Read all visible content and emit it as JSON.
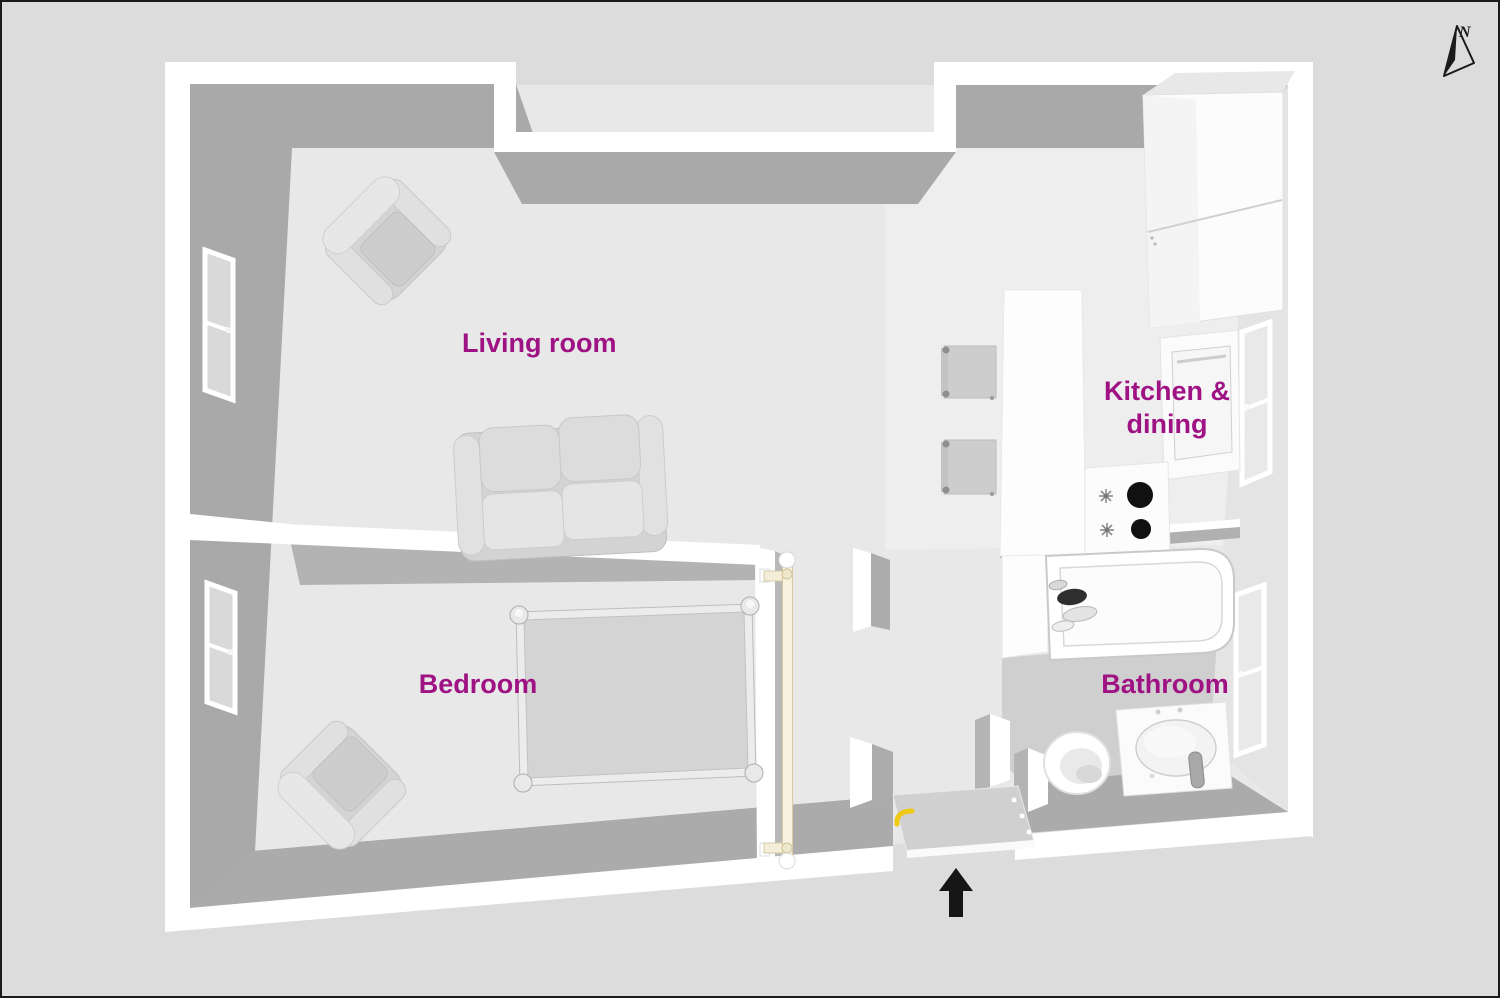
{
  "canvas": {
    "width": 1500,
    "height": 998,
    "background": "#dcdcdc",
    "border": "#1a1a1a"
  },
  "palette": {
    "wall_top": "#ffffff",
    "wall_shadow_face": "#a9a9a9",
    "wall_light_face": "#e4e4e4",
    "floor": "#e8e8e8",
    "floor_kitchen": "#eeeeee",
    "floor_bathroom": "#cfcfcf",
    "furniture_gray": "#d5d5d5",
    "label_text": "#9e1283",
    "entry_arrow": "#161616",
    "door_handle_yellow": "#f0c913",
    "hall_door_cream": "#f7f1de",
    "burner_black": "#111111"
  },
  "compass": {
    "label": "N"
  },
  "rooms": [
    {
      "id": "living-room",
      "label": "Living room"
    },
    {
      "id": "kitchen-dining",
      "label_line1": "Kitchen &",
      "label_line2": "dining"
    },
    {
      "id": "bedroom",
      "label": "Bedroom"
    },
    {
      "id": "bathroom",
      "label": "Bathroom"
    }
  ],
  "furniture": {
    "living_room": [
      "armchair",
      "two-seat-sofa"
    ],
    "bedroom": [
      "double-bed",
      "armchair"
    ],
    "kitchen": [
      "fridge-freezer",
      "oven-cabinet",
      "cooktop-two-burners",
      "counter-table",
      "dining-chair",
      "dining-chair"
    ],
    "bathroom": [
      "bathtub",
      "toilet",
      "washbasin-vanity"
    ],
    "hallway": [
      "open-door-leaf",
      "entry-door-with-yellow-handle"
    ]
  },
  "windows": {
    "left_wall": 2,
    "kitchen_right_wall": 1,
    "bathroom_right_wall": 1
  },
  "entrance": {
    "indicator": "black-arrow-pointing-up"
  }
}
